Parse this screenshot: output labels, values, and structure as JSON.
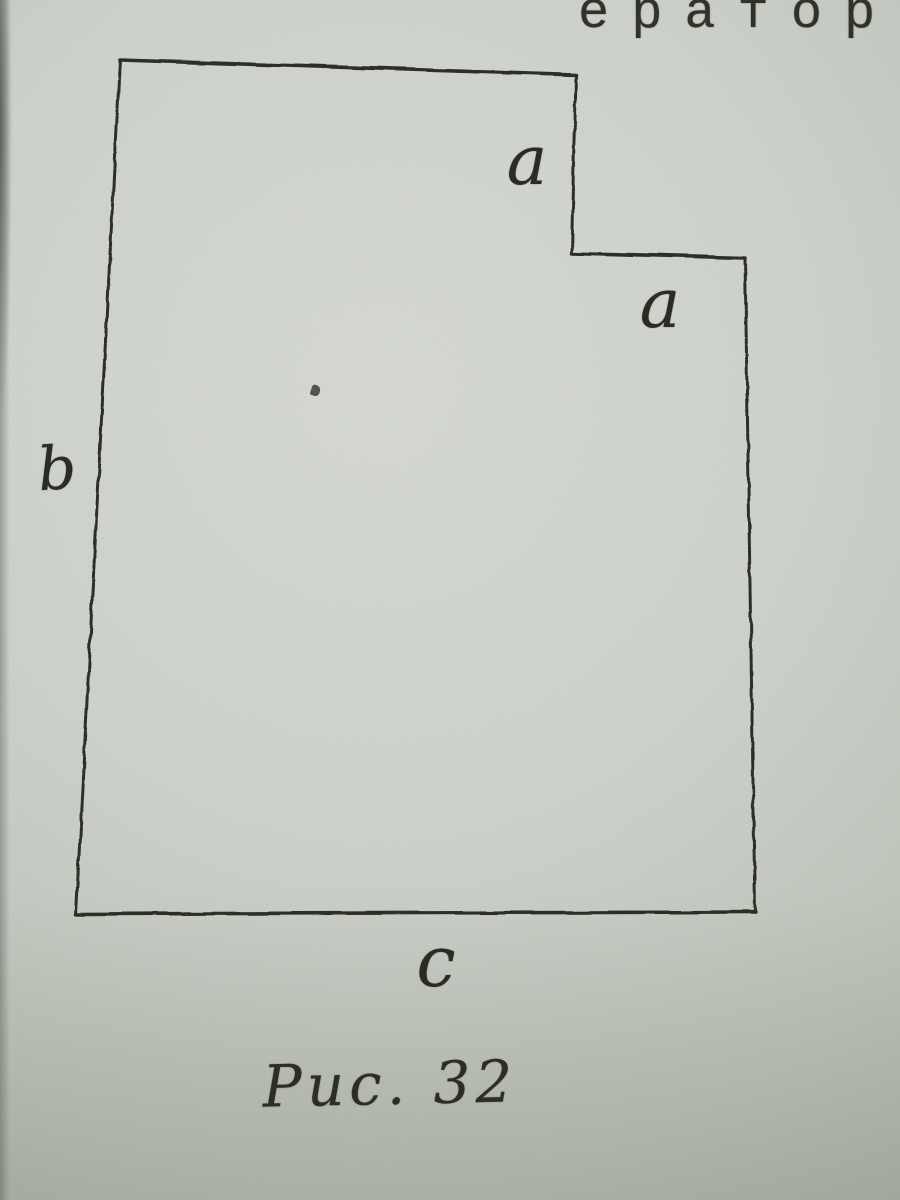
{
  "photo": {
    "partial_top_text": "ератор",
    "caption": "Рис. 32"
  },
  "diagram": {
    "labels": {
      "a_top": "a",
      "a_step": "a",
      "b_left": "b",
      "c_bottom": "c"
    },
    "shape": {
      "description": "quadrilateral with a rectangular notch cut from the top-right corner; notch step edges labeled a and a, left side labeled b, bottom labeled c",
      "vertices": [
        [
          120,
          60
        ],
        [
          576,
          75
        ],
        [
          572,
          253
        ],
        [
          745,
          258
        ],
        [
          755,
          912
        ],
        [
          76,
          914
        ]
      ],
      "edges": [
        {
          "from": 0,
          "to": 1,
          "texture": "solid",
          "name": "top"
        },
        {
          "from": 1,
          "to": 2,
          "texture": "rough",
          "name": "notch-right"
        },
        {
          "from": 2,
          "to": 3,
          "texture": "solid",
          "name": "notch-bottom"
        },
        {
          "from": 3,
          "to": 4,
          "texture": "rough",
          "name": "right"
        },
        {
          "from": 4,
          "to": 5,
          "texture": "solid",
          "name": "bottom"
        },
        {
          "from": 5,
          "to": 0,
          "texture": "rough",
          "name": "left"
        }
      ]
    },
    "colors": {
      "ink": "#2f2f28",
      "paper": "#ccd1c9"
    }
  }
}
